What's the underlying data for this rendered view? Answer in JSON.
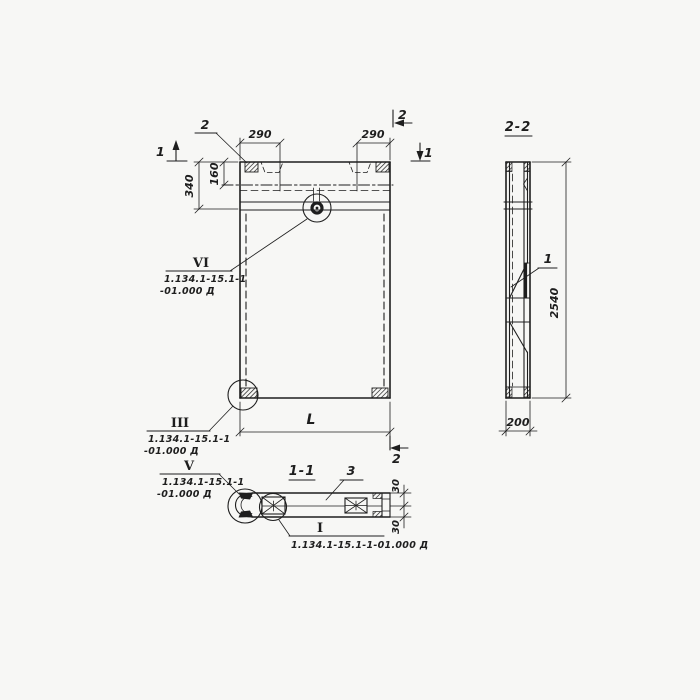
{
  "colors": {
    "ink": "#1e1e1e",
    "paper": "#f7f7f5"
  },
  "plan": {
    "item_label": "2",
    "section_mark_1_left": "1",
    "section_mark_1_right": "1",
    "section_mark_2_top": "2",
    "section_mark_2_bottom": "2",
    "dim_290_left": "290",
    "dim_290_right": "290",
    "dim_340": "340",
    "dim_160": "160",
    "dim_length": "L"
  },
  "section_2_2": {
    "title": "2-2",
    "item_label": "1",
    "dim_height": "2540",
    "dim_width": "200"
  },
  "section_1_1": {
    "title": "1-1",
    "item_label": "3",
    "dim_30_top": "30",
    "dim_30_bottom": "30"
  },
  "callouts": {
    "vi": {
      "mark": "VI",
      "line1": "1.134.1-15.1-1",
      "line2": "-01.000 Д"
    },
    "iii": {
      "mark": "III",
      "line1": "1.134.1-15.1-1",
      "line2": "-01.000 Д"
    },
    "v": {
      "mark": "V",
      "line1": "1.134.1-15.1-1",
      "line2": "-01.000 Д"
    },
    "i": {
      "mark": "I",
      "ref": "1.134.1-15.1-1-01.000 Д"
    }
  }
}
